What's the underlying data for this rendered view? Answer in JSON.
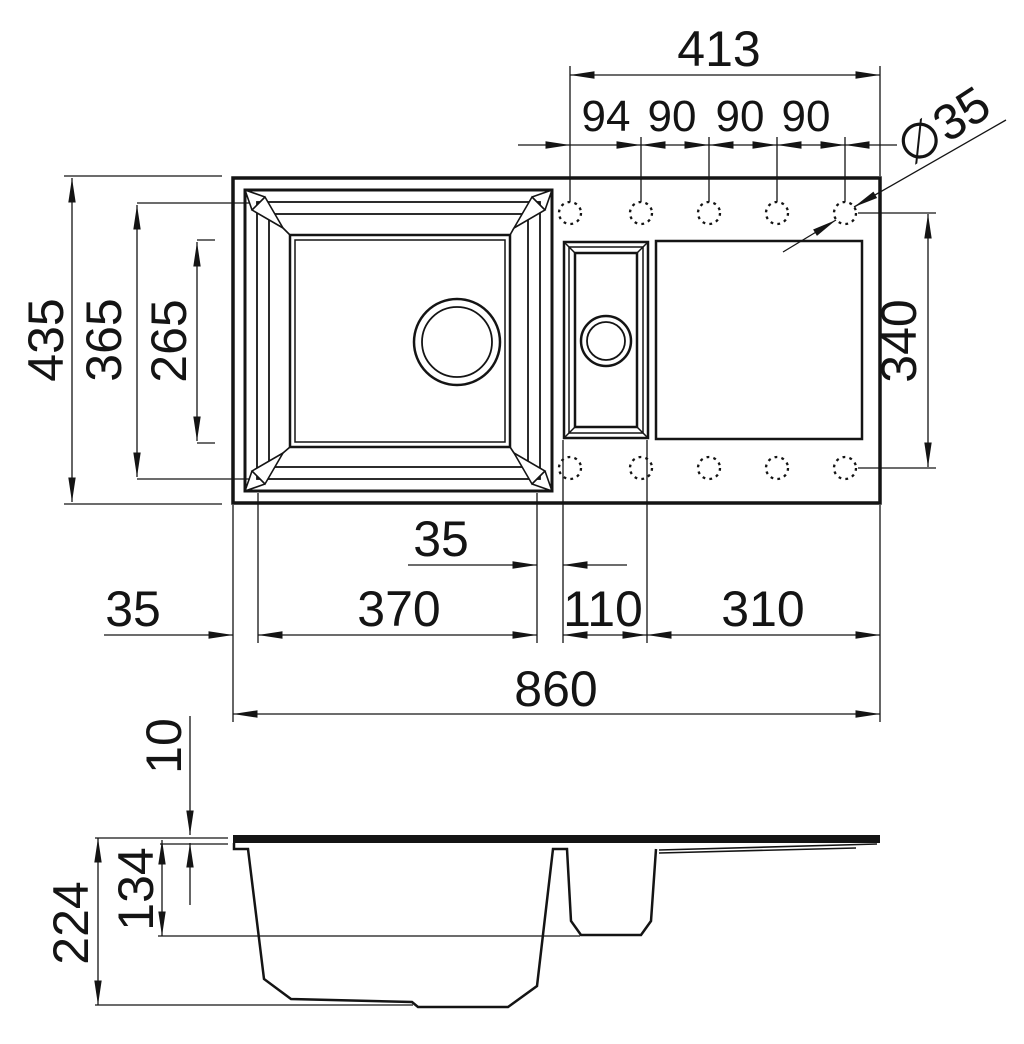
{
  "drawing": {
    "background": "#ffffff",
    "line_color": "#141414",
    "plan": {
      "dim_hole_span_overall": "413",
      "dim_hole_pitch": [
        "94",
        "90",
        "90",
        "90"
      ],
      "dim_hole_diameter": "∅35",
      "dim_overall_depth": "435",
      "dim_bowl_outer_depth": "365",
      "dim_bowl_inner_depth": "265",
      "dim_drainer_hole_span": "340",
      "dim_bowl_gap": "35",
      "dim_left_edge_offset": "35",
      "dim_main_bowl_width": "370",
      "dim_half_bowl_width": "110",
      "dim_drainer_width": "310",
      "dim_overall_width": "860"
    },
    "section": {
      "dim_rim_thickness": "10",
      "dim_half_bowl_depth": "134",
      "dim_main_bowl_depth": "224"
    }
  }
}
